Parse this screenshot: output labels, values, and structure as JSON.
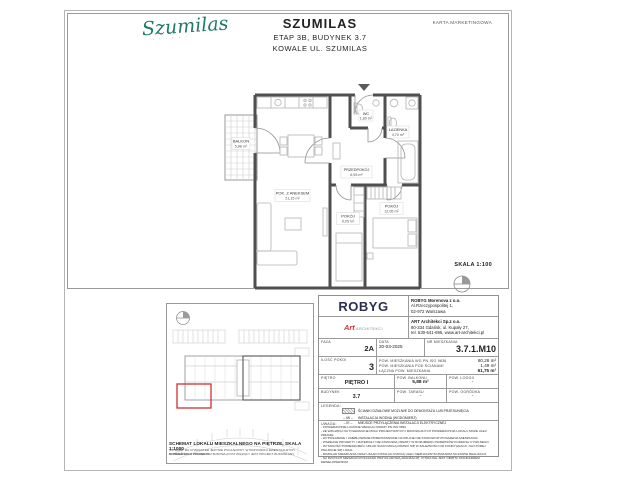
{
  "header": {
    "logo_text": "Szumilas",
    "logo_dots": "· · · · · ·",
    "title": "SZUMILAS",
    "subtitle1": "ETAP 3B, BUDYNEK 3.7",
    "subtitle2": "KOWALE  UL. SZUMILAS",
    "corner_label": "KARTA MARKETINGOWA"
  },
  "plan": {
    "scale_label": "SKALA 1:100",
    "rooms": [
      {
        "name": "BALKON",
        "area": "5,88 m²"
      },
      {
        "name": "POK. Z ANEKSEM",
        "area": "21,15 m²"
      },
      {
        "name": "POKÓJ",
        "area": "9,05 m²"
      },
      {
        "name": "POKÓJ",
        "area": "12,05 m²"
      },
      {
        "name": "PRZEDPOKÓJ",
        "area": "6,95 m²"
      },
      {
        "name": "ŁAZIENKA",
        "area": "4,70 m²"
      },
      {
        "name": "WC",
        "area": "1,80 m²"
      }
    ]
  },
  "site_plan": {
    "caption": "SCHEMAT LOKALU MIESZKALNEGO NA PIĘTRZE, SKALA 1:1000",
    "note1": "SCHEMAT MA CHARAKTER JEDYNIE POGLĄDOWY. W PRZYPADKU EWENTUALNYCH ROZBIEŻNOŚCI POMIĘDZY",
    "note2": "SCHEMATEM, A PROJEKTEM BUDOWLANYM WIĄŻĄCY JEST PROJEKT BUDOWLANY."
  },
  "table": {
    "developer": {
      "logo": "ROBYG",
      "name": "ROBYG Morenova z o.o.",
      "line1": "Al.Rzeczypospolitej 1,",
      "line2": "02-972 Warszawa"
    },
    "architect": {
      "logo_red": "Art",
      "logo_gray": "ARCHITEKCI",
      "name": "ART Architekci Sp.z o.o.",
      "line1": "80-334 Gdańsk, ul. Kupały 27,",
      "line2": "tel. 530-641-696, www.art-architekci.pl"
    },
    "faza": {
      "label": "FAZA",
      "value": "2A"
    },
    "data": {
      "label": "DATA",
      "value": "20-03-2025"
    },
    "nr": {
      "label": "NR MIESZKANIA",
      "value": "3.7.1.M10"
    },
    "ilosc_pokoi": {
      "label": "ILOŚĆ POKOI",
      "value": "3"
    },
    "pow1": {
      "label": "POW. MIESZKANIA  WG PN-ISO 9836",
      "value": "60,26 m²"
    },
    "pow2": {
      "label": "POW. MIESZKANIA POD ŚCIANAMI",
      "value": "1,49 m²"
    },
    "pow3": {
      "label": "ŁĄCZNA POW. MIESZKANIA",
      "value": "61,75 m²"
    },
    "pietro": {
      "label": "PIĘTRO",
      "value": "PIĘTRO I"
    },
    "balkon": {
      "label": "POW. BALKONU",
      "value": "5,88 m²"
    },
    "loggia": {
      "label": "POW. LOGGII",
      "value": "-"
    },
    "budynek": {
      "label": "BUDYNEK",
      "value": "3.7"
    },
    "taras": {
      "label": "POW. TARASU",
      "value": "-"
    },
    "ogrodek": {
      "label": "POW. OGRÓDKA",
      "value": "-"
    },
    "legend": {
      "label": "LEGENDA:",
      "items": [
        {
          "symbol": "",
          "text": "ŚCIANKI DZIAŁOWE MOŻLIWE DO DEMONTAŻU LUB PRZESUNIĘCIA"
        },
        {
          "symbol": "– IW –",
          "text": "INSTALACJA WODNA (WODOMIERZ)"
        },
        {
          "symbol": "– IE –",
          "text": "MIEJSCE PRZYŁĄCZENIA INSTALACJI ELEKTRYCZNEJ"
        }
      ]
    },
    "uwaga": {
      "label": "UWAGA:",
      "lines": [
        "- POWIERZCHNIE LICZONE WEDŁUG NORMY PN-ISO 9836",
        "- ZE WZGLĘDU NA TOLERANCJE PRAC PROJEKTOWYCH I BUDOWLANYCH POWIERZCHNIA LOKALU MOŻE ULEC ZMIANIE",
        "- WYPOSAŻENIE I UMEBLOWANIE PRZEDSTAWIONE NA RZUCIE NIE STANOWI WYPOSAŻENIA MIESZKANIA",
        "- WSZELKIE PROJEKTY I MATERIAŁY NIE STANOWIĄ OFERTY W ROZUMIENIU PRZEPISÓW KODEKSU CYWILNEGO",
        "- WYSOKOŚĆ POMIESZCZEŃ I UKŁAD ŚCIAN MOGĄ RÓŻNIĆ SIĘ W ZALEŻNOŚCI OD KONDYGNACJI, NA KTÓREJ ZNAJDUJE SIĘ LOKAL",
        "- ROZKŁAD MIESZKANIA ORAZ UKŁAD INSTALACJI MOGĄ ULEC NIEZNACZNYM ZMIANOM NA ETAPIE REALIZACJI",
        "- NA RZUTACH MIESZKAŃ POKAZANO PRZYKŁADOWĄ ARANŻACJĘ, KTÓRA NIE JEST OBJĘTA STANDARDEM DEWELOPERSKIM"
      ]
    }
  },
  "colors": {
    "brand_teal": "#1e7a69",
    "robyg_navy": "#2b2e52",
    "art_red": "#d43535",
    "unit_highlight_red": "#d03030",
    "wall_gray": "#4f4f4f"
  }
}
